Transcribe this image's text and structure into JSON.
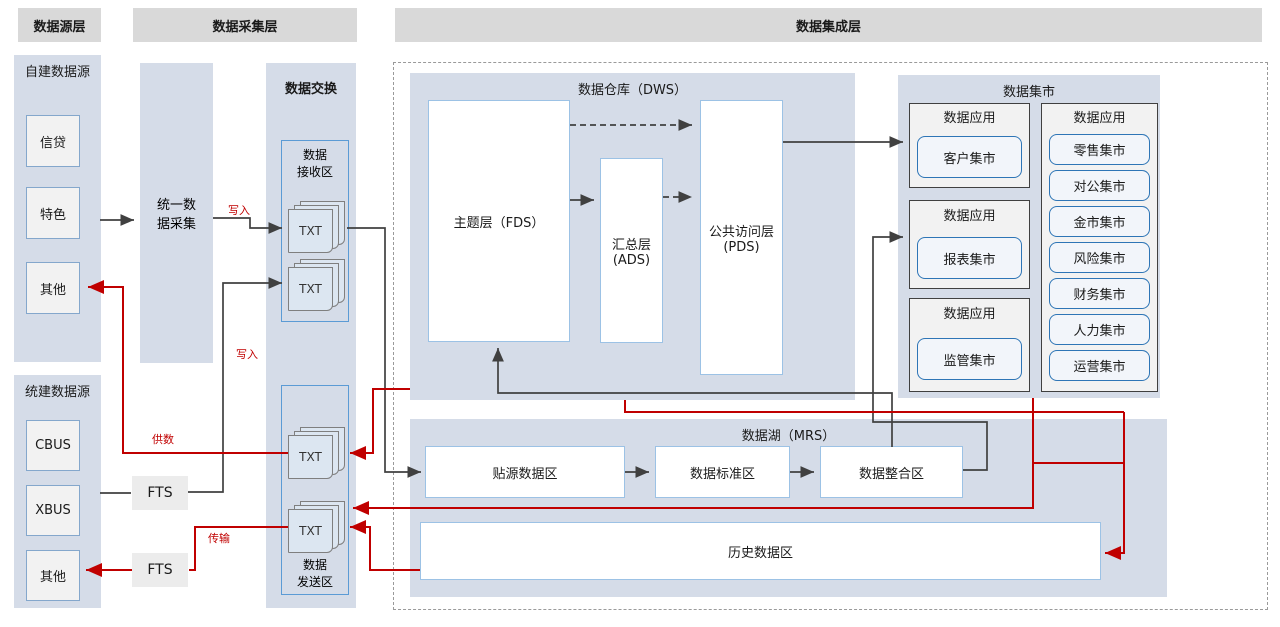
{
  "headers": {
    "source": "数据源层",
    "collection": "数据采集层",
    "integration": "数据集成层"
  },
  "source_layer": {
    "self_built": {
      "title": "自建数据源",
      "items": [
        "信贷",
        "特色",
        "其他"
      ]
    },
    "unified_built": {
      "title": "统建数据源",
      "items": [
        "CBUS",
        "XBUS",
        "其他"
      ]
    }
  },
  "collection_layer": {
    "unified_collect": "统一数\n据采集",
    "fts": [
      "FTS",
      "FTS"
    ],
    "exchange_title": "数据交换",
    "receive_zone": {
      "title": "数据\n接收区",
      "files": [
        "TXT",
        "TXT"
      ]
    },
    "send_zone": {
      "title": "数据\n发送区",
      "files": [
        "TXT",
        "TXT"
      ]
    }
  },
  "integration_layer": {
    "warehouse": {
      "title": "数据仓库（DWS）",
      "fds": "主题层（FDS）",
      "ads": "汇总层\n(ADS)",
      "pds": "公共访问层\n(PDS)"
    },
    "mart": {
      "title": "数据集市",
      "apps": [
        {
          "title": "数据应用",
          "item": "客户集市"
        },
        {
          "title": "数据应用",
          "item": "报表集市"
        },
        {
          "title": "数据应用",
          "item": "监管集市"
        }
      ],
      "multi": {
        "title": "数据应用",
        "items": [
          "零售集市",
          "对公集市",
          "金市集市",
          "风险集市",
          "财务集市",
          "人力集市",
          "运营集市"
        ]
      }
    },
    "lake": {
      "title": "数据湖（MRS）",
      "zones": [
        "贴源数据区",
        "数据标准区",
        "数据整合区"
      ],
      "history": "历史数据区"
    }
  },
  "edge_labels": {
    "write_top": "写入",
    "write_mid": "写入",
    "supply": "供数",
    "transfer": "传输"
  },
  "colors": {
    "red": "#c00000",
    "black": "#404040",
    "container": "#d5dce8",
    "header": "#d9d9d9",
    "blue_border": "#5b9bd5"
  }
}
